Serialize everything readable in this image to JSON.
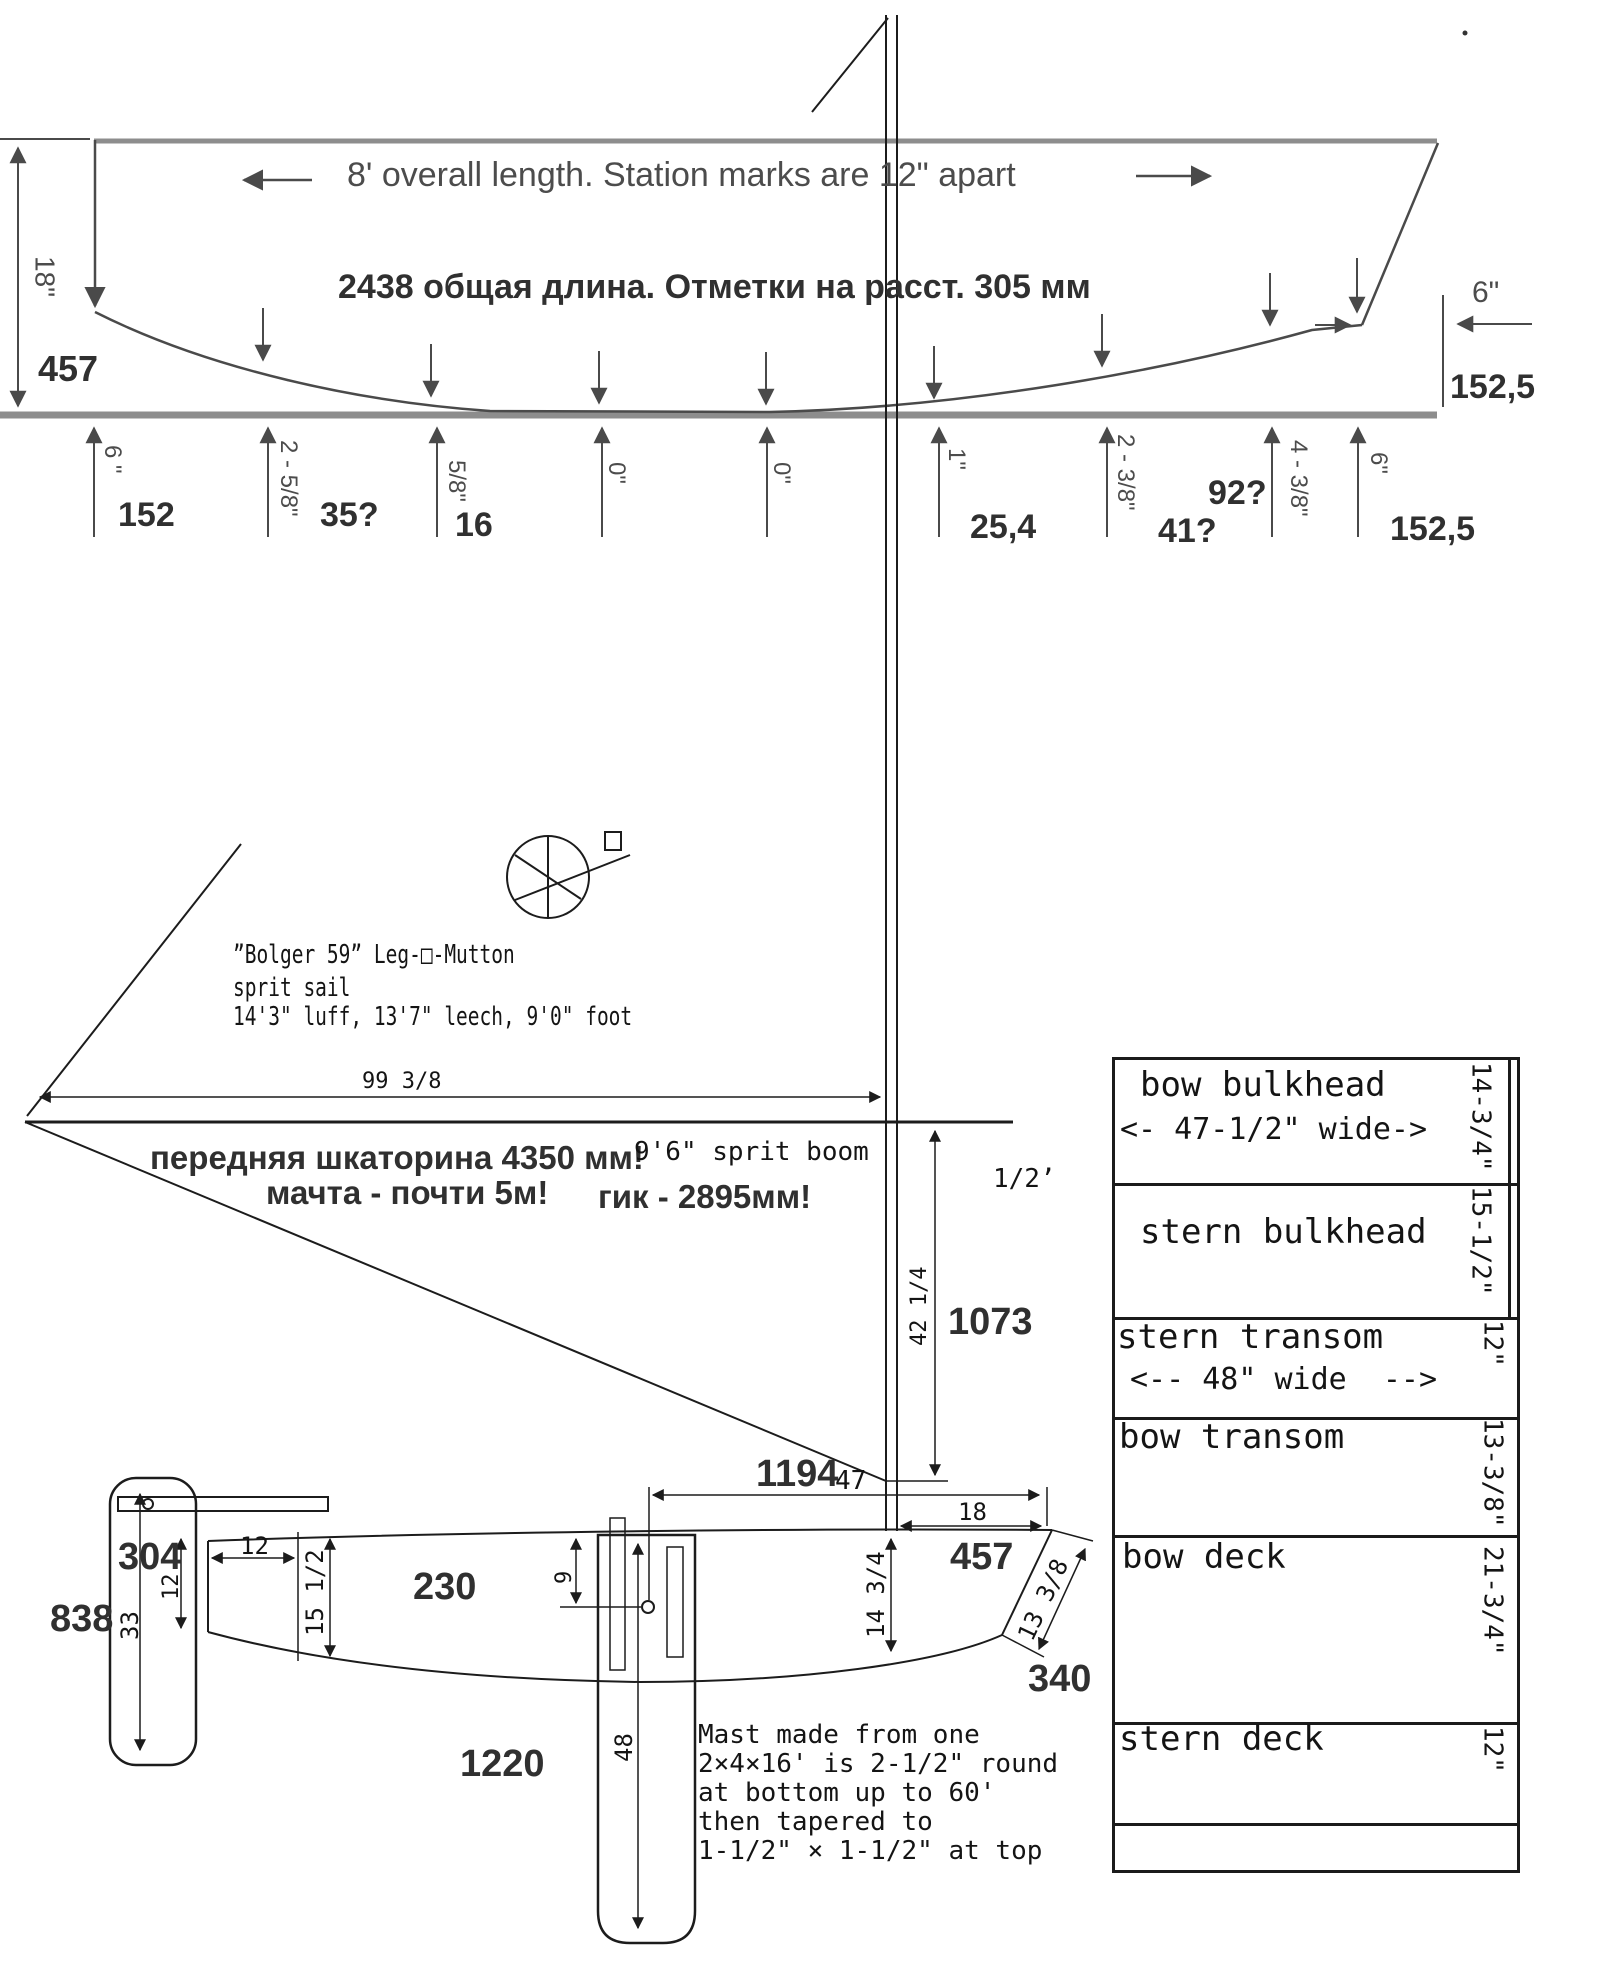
{
  "hull_profile": {
    "note_en": "8' overall length. Station marks are 12\" apart",
    "note_ru": "2438 общая длина. Отметки на расст. 305 мм",
    "height_dim": {
      "inches": "18\"",
      "mm": "457"
    },
    "bow_dim": {
      "inches": "6\"",
      "mm": "152,5"
    },
    "stations": [
      {
        "inches": "6 \"",
        "mm": "152"
      },
      {
        "inches": "2 - 5/8\"",
        "mm": "35?"
      },
      {
        "inches": "5/8\"",
        "mm": "16"
      },
      {
        "inches": "0\"",
        "mm": ""
      },
      {
        "inches": "0\"",
        "mm": ""
      },
      {
        "inches": "1\"",
        "mm": "25,4"
      },
      {
        "inches": "2 - 3/8\"",
        "mm": "41?"
      },
      {
        "inches": "4 - 3/8\"",
        "mm": "92?"
      },
      {
        "inches": "6\"",
        "mm": "152,5"
      }
    ]
  },
  "sail_plan": {
    "title": "”Bolger 59” Leg-□-Mutton",
    "subtitle": "sprit sail",
    "dimensions_line": "14'3\" luff, 13'7\" leech, 9'0\" foot",
    "luff_note_ru": "передняя шкаторина 4350 мм!",
    "mast_note_ru": "мачта - почти 5м!",
    "boom_note_ru": "гик - 2895мм!",
    "boom_label": "9'6\" sprit boom",
    "dim_99": "99 3/8",
    "dim_half": "1/2’",
    "dim_42": "42 1/4",
    "dim_1073": "1073",
    "dim_1194": "1194",
    "dim_47": "47",
    "dim_18": "18",
    "dim_457": "457",
    "dim_340": "340",
    "dim_13_38": "13 3/8",
    "dim_14_34": "14 3/4"
  },
  "side_view": {
    "dim_304": "304",
    "dim_838": "838",
    "dim_230": "230",
    "dim_1220": "1220",
    "dim_12_h": "12",
    "dim_12_v": "12",
    "dim_33": "33",
    "dim_15_12": "15 1/2",
    "dim_9": "9",
    "dim_48": "48"
  },
  "mast_note": {
    "lines": [
      "Mast made from one",
      "2×4×16' is 2-1/2\" round",
      "at bottom up to 60'",
      "then tapered to",
      "1-1/2\" × 1-1/2\" at top"
    ]
  },
  "panels_table": {
    "rows": [
      {
        "label": "bow bulkhead",
        "label2": "<- 47-1/2\" wide->",
        "dim": "14-3/4\""
      },
      {
        "label": "stern bulkhead",
        "label2": "",
        "dim": "15-1/2\""
      },
      {
        "label": "stern transom",
        "label2": "<-- 48\" wide  -->",
        "dim": "12\""
      },
      {
        "label": "bow transom",
        "label2": "",
        "dim": "13-3/8\""
      },
      {
        "label": "bow deck",
        "label2": "",
        "dim": "21-3/4\""
      },
      {
        "label": "stern deck",
        "label2": "",
        "dim": "12\""
      }
    ]
  }
}
